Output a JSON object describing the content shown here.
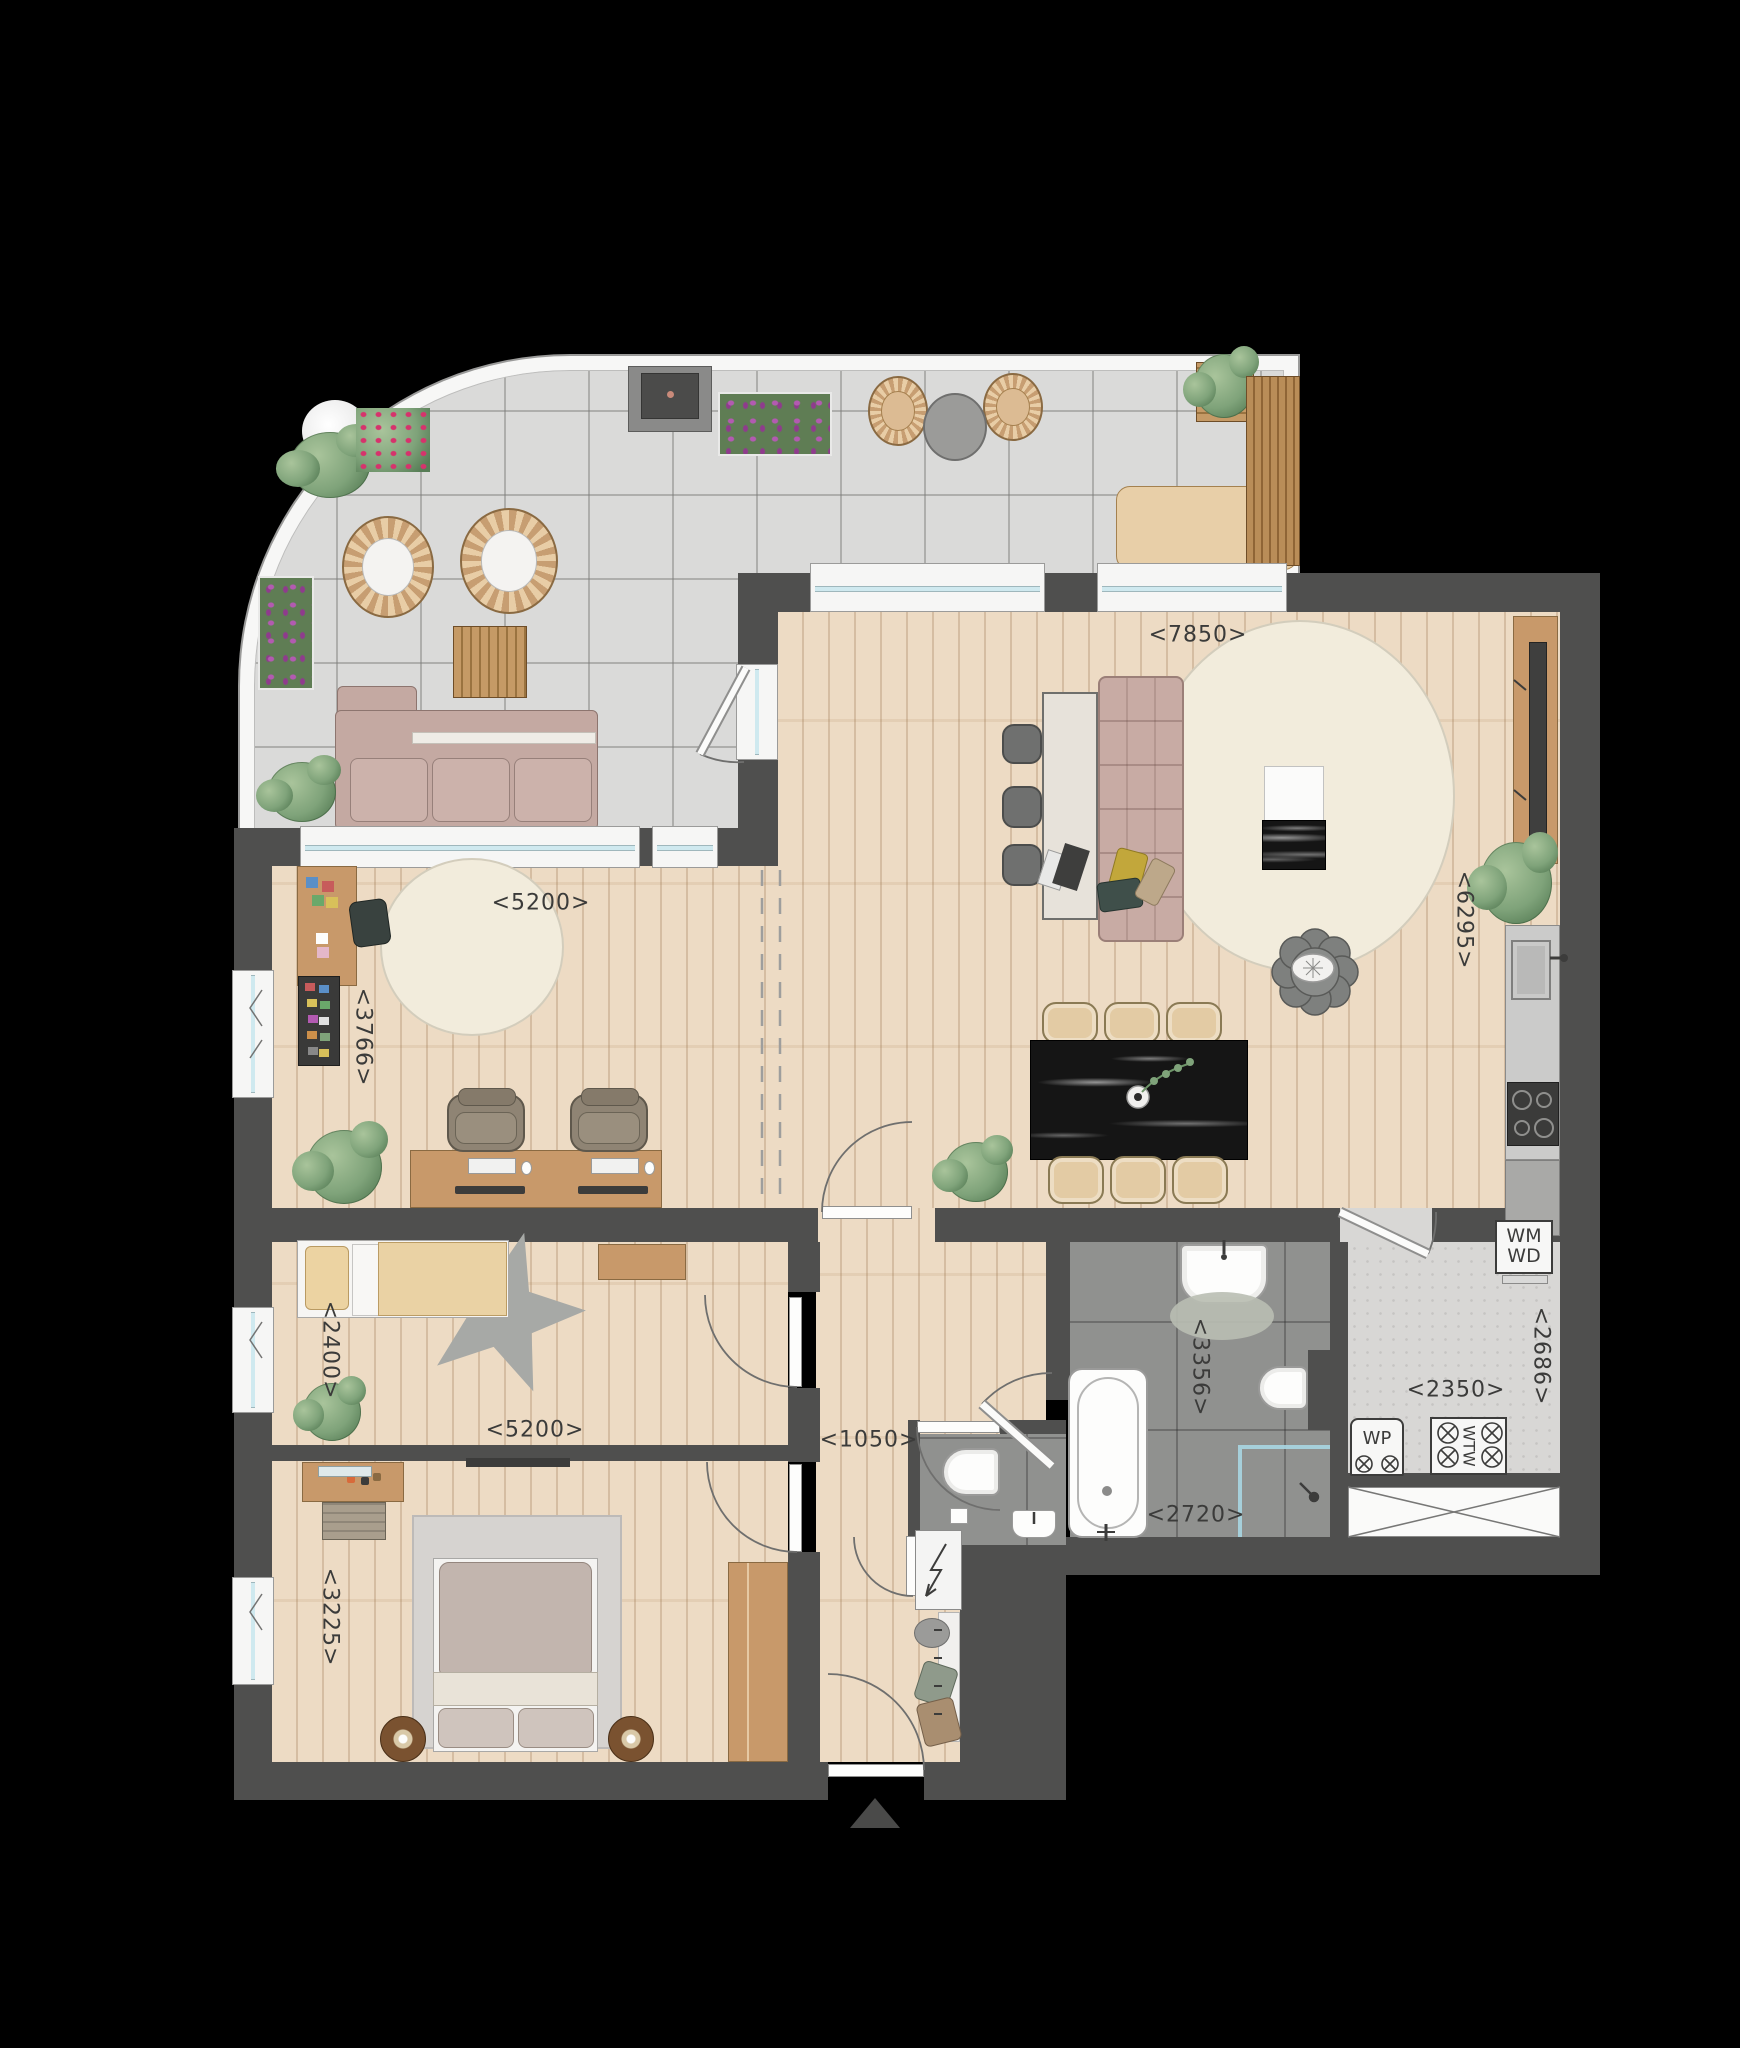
{
  "labels": {
    "dims": [
      {
        "id": "living-width",
        "text": "<7850>"
      },
      {
        "id": "kitchen-depth",
        "text": "<6295>"
      },
      {
        "id": "study-width",
        "text": "<5200>"
      },
      {
        "id": "study-depth",
        "text": "<3766>"
      },
      {
        "id": "child-depth",
        "text": "<2400>"
      },
      {
        "id": "child-width",
        "text": "<5200>"
      },
      {
        "id": "master-depth",
        "text": "<3225>"
      },
      {
        "id": "hall-width",
        "text": "<1050>"
      },
      {
        "id": "bath-depth",
        "text": "<3356>"
      },
      {
        "id": "bath-width",
        "text": "<2720>"
      },
      {
        "id": "utility-width",
        "text": "<2350>"
      },
      {
        "id": "utility-depth",
        "text": "<2686>"
      }
    ],
    "appliances": {
      "washer": "WM",
      "dryer": "WD",
      "heat_pump": "WP",
      "heat_recovery": "WTW"
    }
  },
  "colors": {
    "background": "#000000",
    "wall": "#4f4f4e",
    "wood_floor": "#ecd9c0",
    "terrace_tile": "#dadad9",
    "bath_tile": "#90918f",
    "utility_floor": "#d8d7d5",
    "sofa": "#c8aba4",
    "chair_beige": "#e3cba4",
    "furniture_wood": "#c8996a",
    "marble_black": "#151515",
    "rug_cream": "#f2ecdc",
    "glass": "#cfe9ef",
    "plant_green": "#7fa37a",
    "flower_purple": "#b35ab1"
  }
}
